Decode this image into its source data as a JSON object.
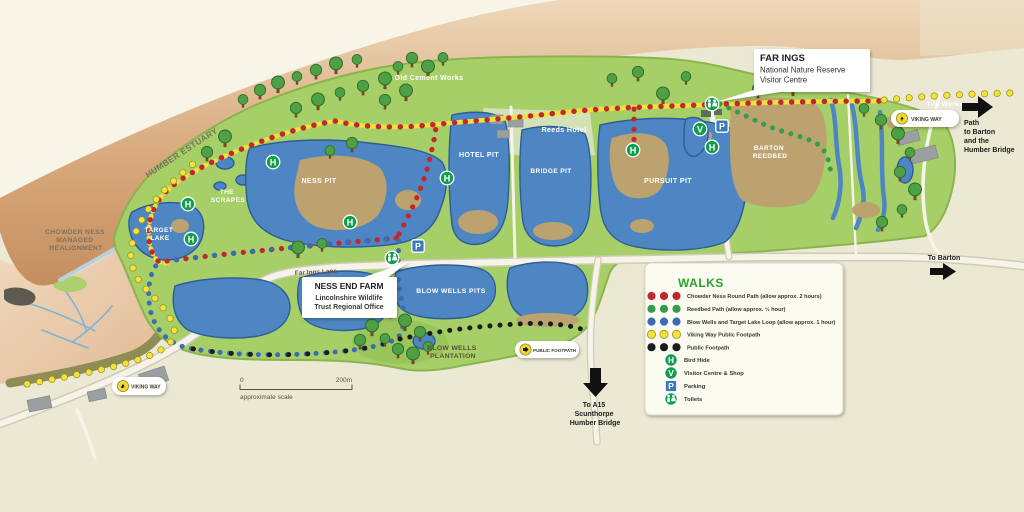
{
  "map": {
    "region_labels": {
      "humber_estuary": "HUMBER ESTUARY",
      "chowder_ness": [
        "CHOWDER NESS",
        "MANAGED",
        "REALIGNMENT"
      ],
      "the_scrapes": [
        "THE",
        "SCRAPES"
      ],
      "target_lake": [
        "TARGET",
        "LAKE"
      ],
      "ness_pit": "NESS PIT",
      "hotel_pit": "HOTEL PIT",
      "bridge_pit": "BRIDGE PIT",
      "pursuit_pit": "PURSUIT PIT",
      "barton_reedbed": [
        "BARTON",
        "REEDBED"
      ],
      "old_cement_works": "Old Cement Works",
      "reeds_hotel": "Reeds Hotel",
      "far_ings_lane": "Far Ings Lane",
      "blow_wells_pits": "BLOW WELLS PITS",
      "blow_wells_plantation": [
        "BLOW WELLS",
        "PLANTATION"
      ],
      "tile_works": "Tile Works"
    },
    "directions": {
      "to_barton": "To Barton",
      "path_to_barton": [
        "Path",
        "to Barton",
        "and the",
        "Humber Bridge"
      ],
      "to_a15": [
        "To A15",
        "Scunthorpe",
        "Humber Bridge"
      ]
    },
    "callouts": {
      "far_ings": {
        "title": "FAR INGS",
        "line1": "National Nature Reserve",
        "line2": "Visitor Centre"
      },
      "ness_end_farm": {
        "title": "NESS END FARM",
        "line1": "Lincolnshire Wildlife",
        "line2": "Trust Regional Office"
      }
    },
    "badges": {
      "viking_way": "VIKING WAY",
      "public_footpath": "PUBLIC FOOTPATH"
    },
    "scale_bar": {
      "start": "0",
      "end": "200m",
      "caption": "approximate scale"
    },
    "legend": {
      "title": "WALKS",
      "routes": [
        {
          "name": "Chowder Ness Round Path (allow approx. 2 hours)",
          "color": "#c1272d"
        },
        {
          "name": "Reedbed Path (allow approx. ½ hour)",
          "color": "#2f9e4f"
        },
        {
          "name": "Blow Wells and Target Lake Loop (allow approx. 1 hour)",
          "color": "#3b6cb4"
        },
        {
          "name": "Viking Way Public Footpath",
          "color": "#f2e23c"
        },
        {
          "name": "Public Footpath",
          "color": "#1c1c1c"
        }
      ],
      "symbols": [
        {
          "icon": "bird-hide",
          "glyph": "H",
          "label": "Bird Hide"
        },
        {
          "icon": "visitor-centre",
          "glyph": "V",
          "label": "Visitor Centre & Shop"
        },
        {
          "icon": "parking",
          "glyph": "P",
          "label": "Parking"
        },
        {
          "icon": "toilets",
          "glyph": "",
          "label": "Toilets"
        }
      ]
    },
    "colors": {
      "background": "#ebe8d3",
      "reserve_green": "#a6cf67",
      "water_blue": "#4d86c2",
      "reedbed_tan": "#bca26f",
      "estuary_mud": "#c89165",
      "walk_red": "#c1272d",
      "walk_green": "#2f9e4f",
      "walk_blue": "#3b6cb4",
      "walk_yellow": "#f2e23c",
      "walk_black": "#1c1c1c",
      "marker_green": "#0f9d4e",
      "parking_blue": "#3a7ab8",
      "legend_title": "#2fa12f"
    }
  },
  "glyphs": {
    "bird_hide": "H",
    "visitor_centre": "V",
    "parking": "P"
  }
}
